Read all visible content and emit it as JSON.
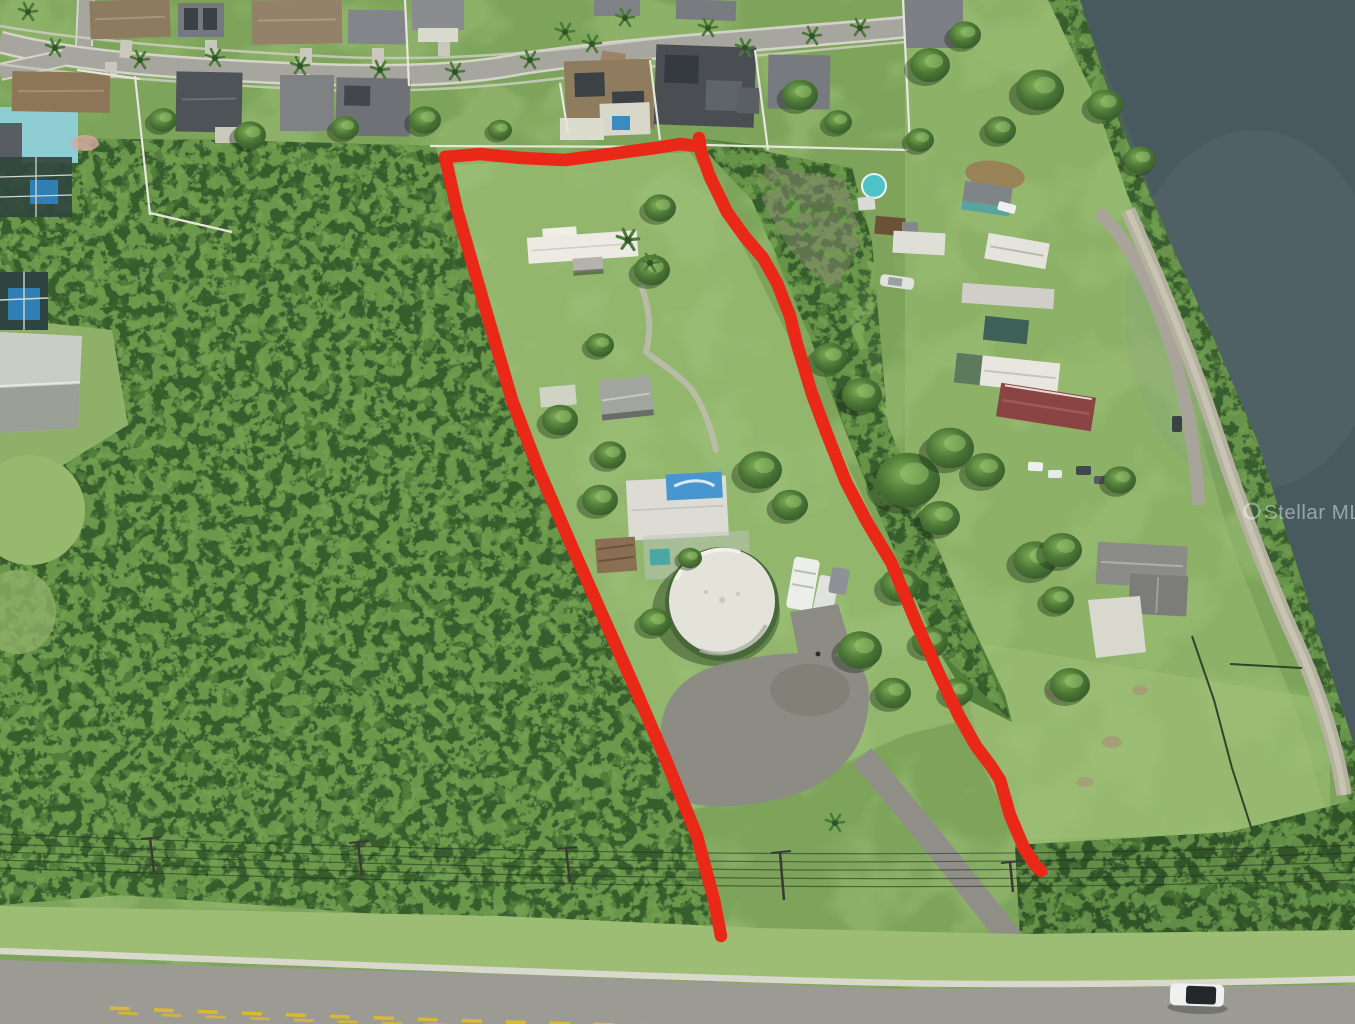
{
  "image": {
    "kind": "aerial-property-listing-photo",
    "watermark": {
      "text": "Stellar MLS"
    }
  },
  "colors": {
    "boundary_red": "#ea2817",
    "water": "#48595f",
    "water_light": "#5d7a78",
    "woods_base": "#517e3b",
    "woods_dark": "#33552a",
    "woods_light": "#7cab57",
    "grass": "#8db168",
    "grass_bright": "#a3c47c",
    "verge_green": "#9dbd74",
    "road_asphalt": "#9b9b93",
    "street_gray": "#a6a69e",
    "sidewalk": "#d8d8cc",
    "driveway_gray": "#8f8f88",
    "dirt_road_tan": "#b5b1a0",
    "parking_gray": "#8c8c85",
    "tank_white": "#e3e3da",
    "tank_base_green": "#48683a",
    "tarp_blue": "#4796cf",
    "pool_teal": "#4ec3c7",
    "pool_blue": "#2f7fb5",
    "roof_brown": "#8f7c64",
    "roof_gray": "#7e8185",
    "roof_charcoal": "#4e5357",
    "roof_maroon": "#8a4444",
    "roof_white": "#eceae2",
    "metal_building": "#c9cdc4",
    "teal_house_wall": "#8ecdd3",
    "fence_white": "#e6e6de",
    "center_line_yellow": "#d9b838",
    "power_line": "#2a3a28",
    "car_body_white": "#eff1f0",
    "car_roof_black": "#23272b",
    "watermark_white": "#ffffff"
  }
}
